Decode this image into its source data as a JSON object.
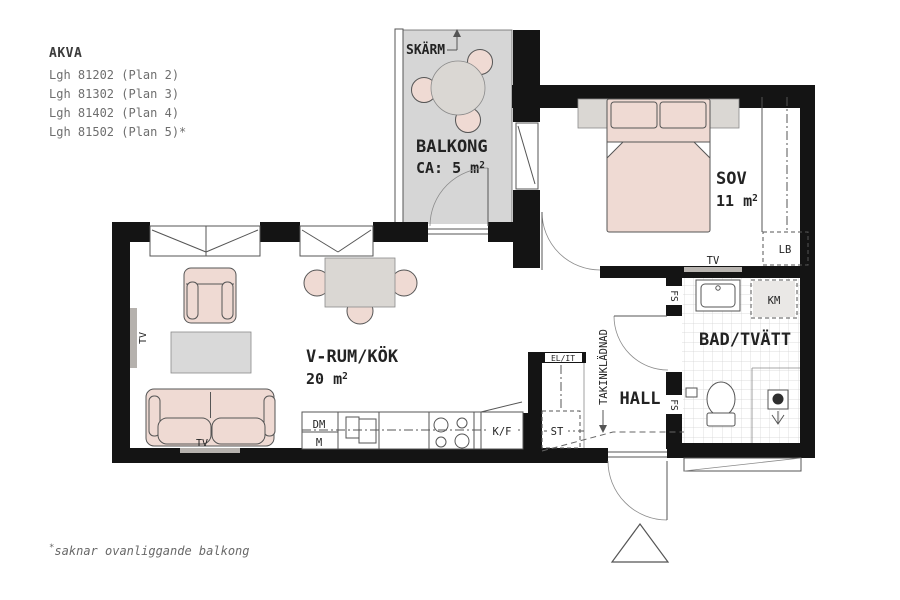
{
  "header": {
    "project": "AKVA",
    "apartments": [
      "Lgh 81202 (Plan 2)",
      "Lgh 81302 (Plan 3)",
      "Lgh 81402 (Plan 4)",
      "Lgh 81502 (Plan 5)*"
    ]
  },
  "footnote": {
    "mark": "*",
    "text": "saknar ovanliggande balkong"
  },
  "rooms": {
    "balcony": {
      "name": "BALKONG",
      "area": "CA: 5 m",
      "area_sup": "2",
      "screen": "SKÄRM"
    },
    "bedroom": {
      "name": "SOV",
      "area": "11 m",
      "area_sup": "2"
    },
    "living": {
      "name": "V-RUM/KÖK",
      "area": "20 m",
      "area_sup": "2"
    },
    "bath": {
      "name": "BAD/TVÄTT"
    },
    "hall": {
      "name": "HALL",
      "ceiling": "TAKINKLÄDNAD"
    }
  },
  "fixtures": {
    "tv": "TV",
    "fs": "FS",
    "km": "KM",
    "lb": "LB",
    "st": "ST",
    "el_it": "EL/IT",
    "dm": "DM",
    "m": "M",
    "kf": "K/F"
  },
  "colors": {
    "wall": "#141414",
    "balcony_floor": "#d6d6d6",
    "furniture_pink": "#efdad3",
    "furniture_gray": "#dad7d3",
    "outline": "#555555"
  }
}
